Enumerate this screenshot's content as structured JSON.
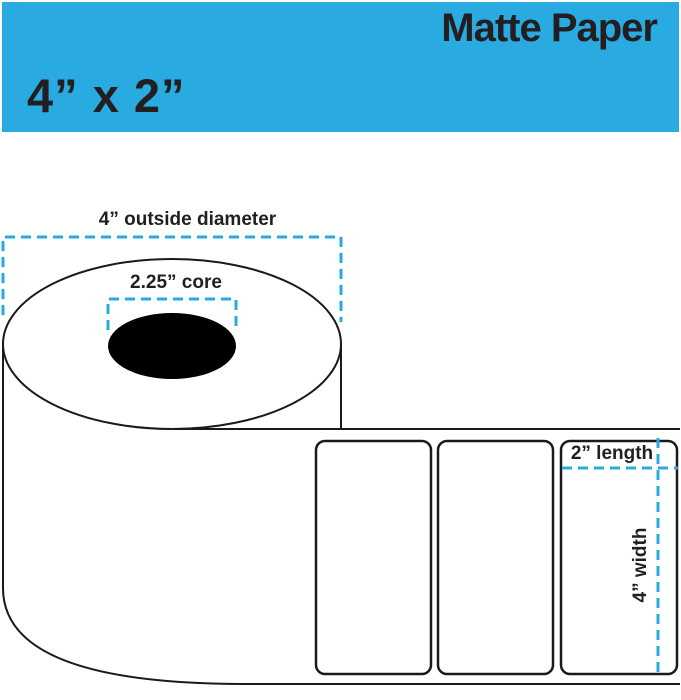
{
  "header": {
    "product_type": "Matte Paper",
    "size": "4” x 2”"
  },
  "diagram": {
    "annotations": {
      "outside_diameter": "4” outside diameter",
      "core": "2.25” core",
      "length": "2” length",
      "width": "4” width"
    },
    "label_count": 3
  },
  "colors": {
    "header_bg": "#29ABE2",
    "dimension_line": "#29ABE2",
    "outline": "#1A1A1A",
    "ink": "#231F20",
    "core_fill": "#000000",
    "label_fill": "#FFFFFF"
  }
}
